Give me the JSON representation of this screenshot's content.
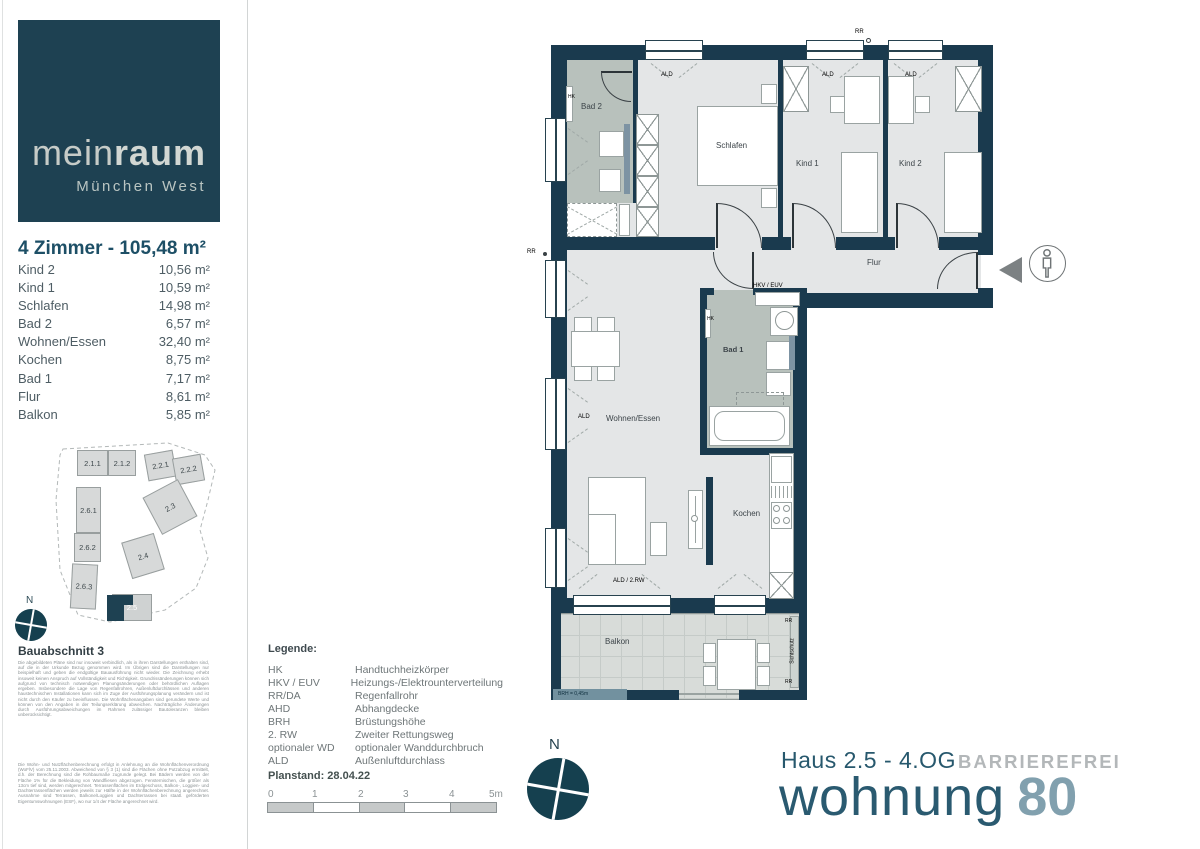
{
  "logo": {
    "brand_thin": "mein",
    "brand_bold": "raum",
    "subtitle": "München West"
  },
  "summary": {
    "title": "4 Zimmer - 105,48 m²",
    "rooms": [
      {
        "name": "Kind 2",
        "area": "10,56 m²"
      },
      {
        "name": "Kind 1",
        "area": "10,59 m²"
      },
      {
        "name": "Schlafen",
        "area": "14,98 m²"
      },
      {
        "name": "Bad 2",
        "area": "6,57 m²"
      },
      {
        "name": "Wohnen/Essen",
        "area": "32,40 m²"
      },
      {
        "name": "Kochen",
        "area": "8,75 m²"
      },
      {
        "name": "Bad 1",
        "area": "7,17 m²"
      },
      {
        "name": "Flur",
        "area": "8,61 m²"
      },
      {
        "name": "Balkon",
        "area": "5,85 m²"
      }
    ]
  },
  "siteplan": {
    "buildings": [
      "2.1.1",
      "2.1.2",
      "2.2.1",
      "2.2.2",
      "2.6.1",
      "2.6.2",
      "2.6.3",
      "2.3",
      "2.4"
    ],
    "highlight": "2.5",
    "compass": "N",
    "caption": "Bauabschnitt 3"
  },
  "disclaimer": {
    "para1": "Die abgebildeten Pläne sind nur insoweit verbindlich, als in ihren Darstellungen enthalten sind, auf die in der Urkunde Bezug genommen wird. Im Übrigen sind die Darstellungen nur beispielhaft und geben die endgültige Bauausführung nicht wieder. Die Zeichnung erhebt insoweit keinen Anspruch auf Vollständigkeit und Richtigkeit. Grundrissänderungen können sich aufgrund von technisch notwendigen Planungsänderungen oder behördlichen Auflagen ergeben. Insbesondere die Lage von Regenfallrohren, Außenluftdurchlässen und anderen haustechnischen Installationen kann sich im Zuge der Ausführungsplanung verändern und ist nicht durch den Käufer zu beeinflussen. Die Wohnflächenangaben sind gerundete Werte und können von den Angaben in der Teilungserklärung abweichen. Nachträgliche Änderungen durch Ausführungsabweichungen im Rahmen zulässiger Bautoleranzen bleiben unberücksichtigt.",
    "para2": "Die Wohn- und Nutzflächenberechnung erfolgt in Anlehnung an die Wohnflächenverordnung (WoFlV) vom 25.11.2003. Abweichend von § 3 (1) sind die Flächen ohne Putzabzug ermittelt, d.h. der Berechnung sind die Rohbaumaße zugrunde gelegt. Bei Bädern werden von der Fläche 1% für die Bekleidung von Wandfliesen abgezogen. Fensternischen, die größer als 13cm tief sind, werden mitgerechnet. Terrassenflächen im Erdgeschoss, Balkon-, Loggien- und Dachterrassenflächen werden jeweils zur Hälfte in der Wohnflächenberechnung angerechnet. Ausnahme sind Terrassen, Balkone/Loggien und Dachterrassen bei staatl. geförderten Eigentumswohnungen (ESF), wo nur 1/4 der Fläche angerechnet wird."
  },
  "legend": {
    "title": "Legende:",
    "items": [
      {
        "abbr": "HK",
        "desc": "Handtuchheizkörper"
      },
      {
        "abbr": "HKV / EUV",
        "desc": "Heizungs-/Elektrounterverteilung"
      },
      {
        "abbr": "RR/DA",
        "desc": "Regenfallrohr"
      },
      {
        "abbr": "AHD",
        "desc": "Abhangdecke"
      },
      {
        "abbr": "BRH",
        "desc": "Brüstungshöhe"
      },
      {
        "abbr": "2. RW",
        "desc": "Zweiter Rettungsweg"
      },
      {
        "abbr": "optionaler WD",
        "desc": "optionaler Wanddurchbruch"
      },
      {
        "abbr": "ALD",
        "desc": "Außenluftdurchlass"
      }
    ]
  },
  "plan_meta": {
    "planstand": "Planstand: 28.04.22",
    "scale_ticks": [
      "0",
      "1",
      "2",
      "3",
      "4",
      "5m"
    ],
    "compass": "N"
  },
  "titleblock": {
    "haus": "Haus 2.5 - 4.OG",
    "badge": "BARRIEREFREI",
    "wohnung": "wohnung",
    "number": "80"
  },
  "floorplan": {
    "rooms": {
      "bad2": "Bad 2",
      "schlafen": "Schlafen",
      "kind1": "Kind 1",
      "kind2": "Kind 2",
      "flur": "Flur",
      "bad1": "Bad 1",
      "wohnen_essen": "Wohnen/Essen",
      "kochen": "Kochen",
      "balkon": "Balkon"
    },
    "annotations": {
      "hk": "HK",
      "ald": "ALD",
      "rr": "RR",
      "hkv_euv": "HKV / EUV",
      "ald_2rw": "ALD / 2.RW",
      "brh": "BRH = 0,45m",
      "sichtschutz": "Sichtschutz"
    }
  },
  "colors": {
    "brand_teal": "#1e4152",
    "wall_navy": "#1a3a4e",
    "accent_blue_gray": "#81a0ae",
    "bad_fill": "#b8c1bc"
  }
}
